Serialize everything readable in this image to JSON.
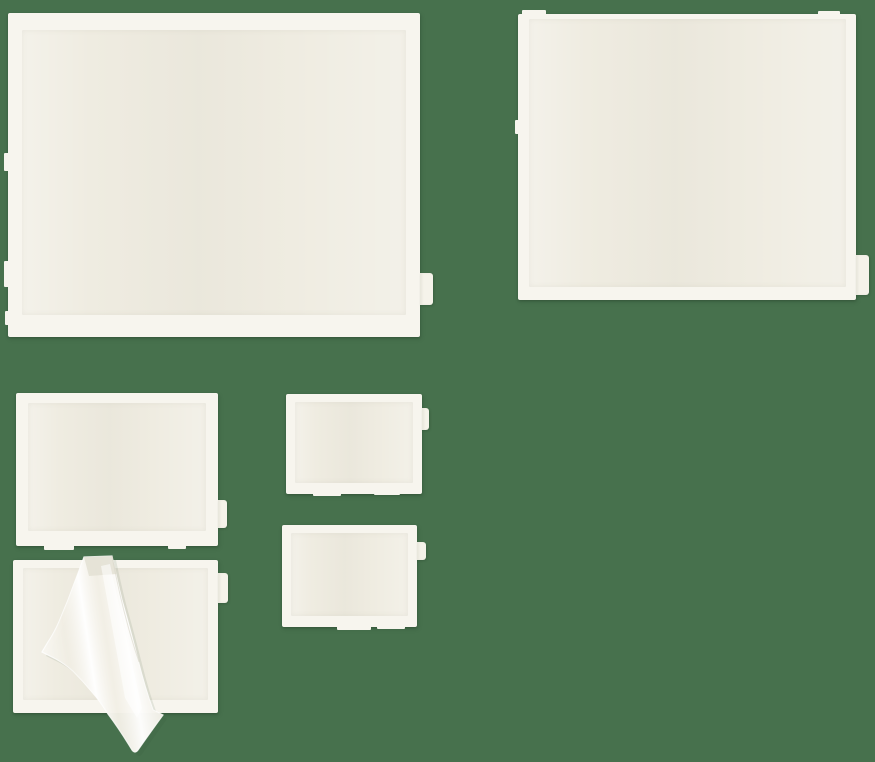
{
  "meta": {
    "description": "Product photograph of six blank cream self-adhesive packing-list pouches of assorted sizes on a plain green background; the bottom-left pouch has its clear protective film partially peeled back",
    "visible_text": ""
  },
  "palette": {
    "background_color": "#47714d",
    "pouch_edge": "#f7f5ee",
    "pouch_body": "#efece1",
    "pouch_body_shade": "#e8e5d9",
    "tab_fill": "#f5f3ea",
    "film_base": "#f4f1e8",
    "film_highlight": "#ffffff",
    "fold_shade": "#e3e0d3"
  },
  "items": [
    {
      "name": "large-pouch-top-left",
      "x": 8,
      "y": 13,
      "w": 412,
      "h": 324,
      "edge": [
        17,
        14,
        22,
        14
      ],
      "tab": {
        "y": 260,
        "w": 13,
        "h": 32
      },
      "nubs": [
        [
          -4,
          140,
          5,
          18
        ],
        [
          -4,
          248,
          5,
          26
        ],
        [
          -3,
          298,
          4,
          14
        ]
      ]
    },
    {
      "name": "large-pouch-top-right",
      "x": 518,
      "y": 14,
      "w": 338,
      "h": 286,
      "edge": [
        5,
        10,
        13,
        11
      ],
      "tab": {
        "y": 241,
        "w": 13,
        "h": 40
      },
      "nubs": [
        [
          4,
          -4,
          24,
          5
        ],
        [
          300,
          -3,
          22,
          4
        ],
        [
          -3,
          106,
          4,
          14
        ]
      ]
    },
    {
      "name": "medium-pouch-middle-left",
      "x": 16,
      "y": 393,
      "w": 202,
      "h": 153,
      "edge": [
        10,
        12,
        15,
        12
      ],
      "tab": {
        "y": 107,
        "w": 9,
        "h": 28
      },
      "nubs": [
        [
          28,
          151,
          30,
          6
        ],
        [
          152,
          151,
          18,
          5
        ]
      ]
    },
    {
      "name": "medium-pouch-bottom-left-peeled",
      "x": 13,
      "y": 560,
      "w": 205,
      "h": 153,
      "edge": [
        8,
        10,
        13,
        10
      ],
      "tab": {
        "y": 13,
        "w": 10,
        "h": 30
      },
      "nubs": []
    },
    {
      "name": "small-pouch-center-top",
      "x": 286,
      "y": 394,
      "w": 136,
      "h": 100,
      "edge": [
        8,
        9,
        11,
        9
      ],
      "tab": {
        "y": 14,
        "w": 7,
        "h": 22
      },
      "nubs": [
        [
          27,
          98,
          28,
          4
        ],
        [
          88,
          98,
          26,
          3
        ]
      ]
    },
    {
      "name": "small-pouch-center-bottom",
      "x": 282,
      "y": 525,
      "w": 135,
      "h": 102,
      "edge": [
        8,
        9,
        11,
        9
      ],
      "tab": {
        "y": 17,
        "w": 9,
        "h": 18
      },
      "nubs": [
        [
          55,
          100,
          34,
          5
        ],
        [
          95,
          100,
          28,
          4
        ]
      ]
    }
  ]
}
